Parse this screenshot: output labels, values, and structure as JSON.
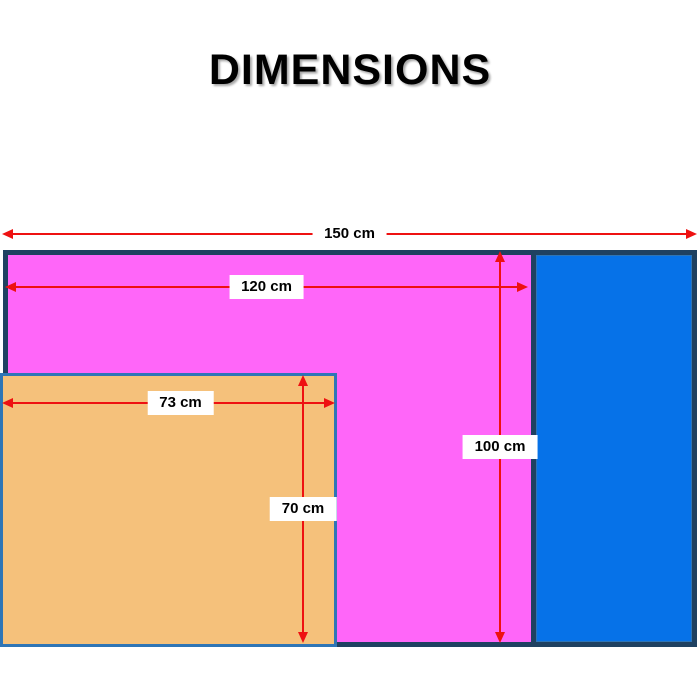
{
  "title": "DIMENSIONS",
  "colors": {
    "outer_border": "#1f4161",
    "inner_border": "#2e75b6",
    "magenta_fill": "#ff66f9",
    "blue_fill": "#0672e8",
    "orange_fill": "#f5c17b",
    "arrow_red": "#ee1111",
    "label_bg": "#ffffff"
  },
  "dimensions": {
    "total_width": {
      "label": "150 cm",
      "orientation": "horizontal",
      "measures": "overall width"
    },
    "magenta_width": {
      "label": "120 cm",
      "orientation": "horizontal",
      "measures": "magenta region width"
    },
    "orange_width": {
      "label": "73 cm",
      "orientation": "horizontal",
      "measures": "orange region width"
    },
    "magenta_height": {
      "label": "100 cm",
      "orientation": "vertical",
      "measures": "magenta region height"
    },
    "orange_height": {
      "label": "70 cm",
      "orientation": "vertical",
      "measures": "orange region height"
    }
  },
  "shapes": {
    "outer": {
      "fill_name": "magenta",
      "border_name": "dark-navy"
    },
    "right": {
      "fill_name": "blue",
      "border_name": "dark-navy"
    },
    "bottom_left": {
      "fill_name": "orange",
      "border_name": "medium-blue"
    }
  }
}
